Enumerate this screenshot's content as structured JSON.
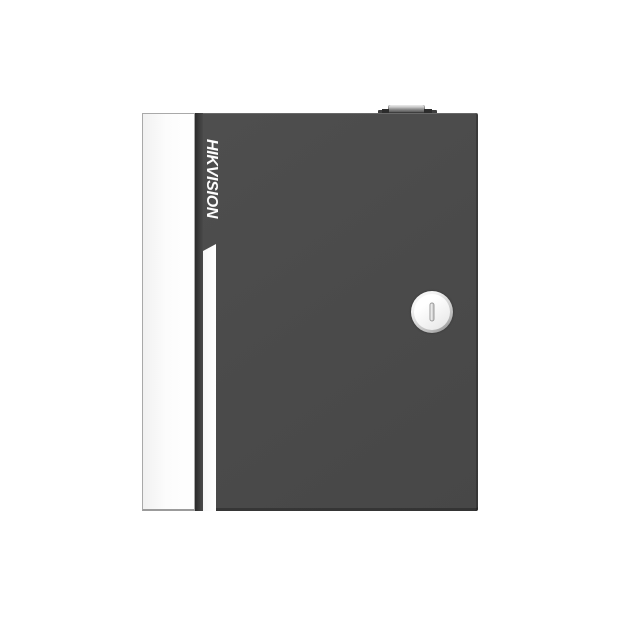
{
  "image_type": "product-photo",
  "background_color": "#ffffff",
  "product": {
    "brand": "HIKVISION",
    "description": "Dark grey wall-mount metal enclosure with white side panel, vertical brand logo, white accent stripe, round cam lock and top latch tab",
    "body_color": "#4a4a4a",
    "side_panel_color": "#fcfcfc",
    "door_edge_color": "#2b2b2b",
    "accent_stripe_color": "#ffffff",
    "top_latch_color": "#3e3e3e",
    "lock": {
      "face_color": "#f3f3f3",
      "slot_color": "#c6c6c6"
    }
  }
}
